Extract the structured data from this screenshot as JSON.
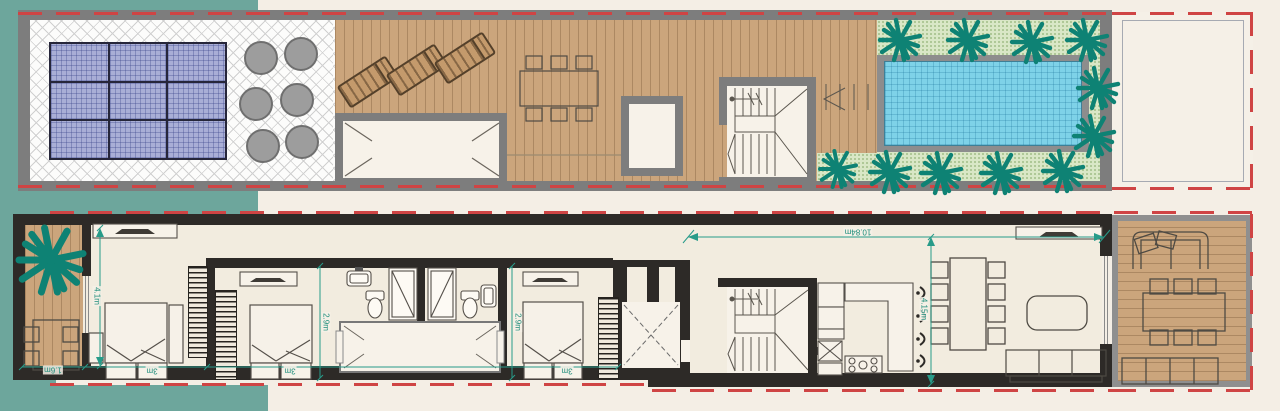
{
  "plan": {
    "dimensions": {
      "terrace_table_width": "1.6m",
      "bedroom1_width": "3m",
      "bedroom2_width": "3m",
      "bedroom3_width": "3m",
      "bedroom1_depth": "4.1m",
      "bathroom1_depth": "2.9m",
      "bathroom2_depth": "2.9m",
      "living_wing_length": "10.84m",
      "living_room_depth": "4.15m"
    },
    "colors": {
      "background": "#f4eee5",
      "site_teal": "#6da69c",
      "palm_green": "#0e8274",
      "wood_deck": "#cba57c",
      "pool_water": "#7ed2e8",
      "hedge_green": "#d9e7c6",
      "solar_panel_blue": "#a9aed6",
      "roof_wall_gray": "#7d7d7d",
      "floor_wall_black": "#2d2a27",
      "dimension_teal": "#1e8d7b",
      "boundary_red": "#cf4444"
    },
    "icons": [
      "palm-tree-icon",
      "sun-lounger-icon",
      "bed-icon",
      "shower-icon",
      "toilet-icon",
      "sink-icon",
      "stove-icon",
      "sofa-icon",
      "stairs-icon",
      "elevator-icon"
    ]
  }
}
